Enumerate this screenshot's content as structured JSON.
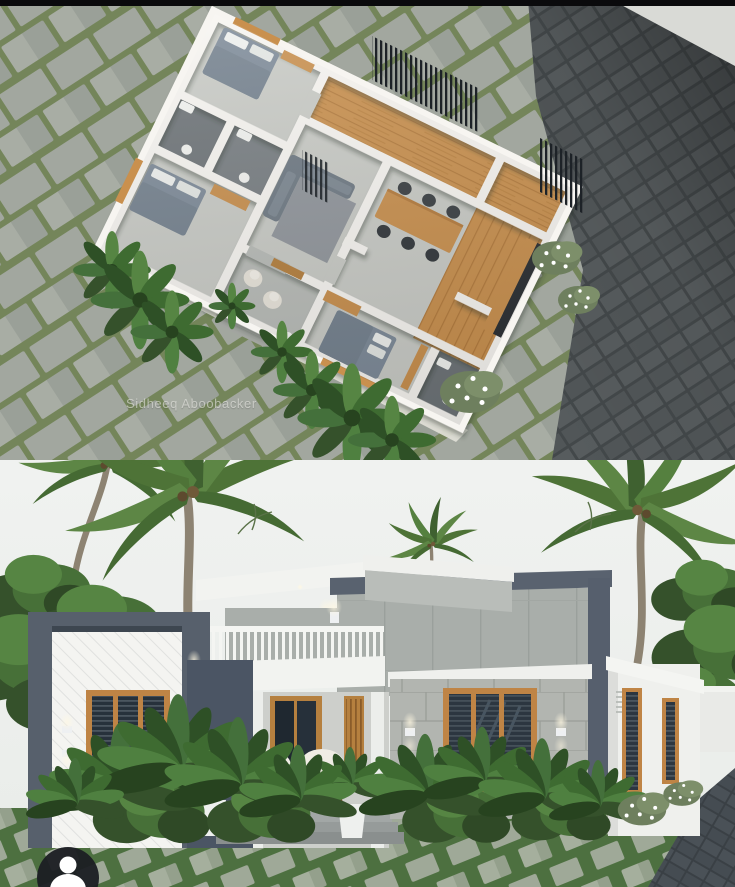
{
  "watermark": {
    "text": "Sidheeq Aboobacker"
  },
  "avatar": {
    "icon": "person-icon"
  },
  "panels": {
    "top": {
      "label": "3D isometric floor plan render"
    },
    "bottom": {
      "label": "House exterior front elevation render"
    }
  },
  "palette": {
    "top_bar": "#0a0a0c",
    "paver_grey": "#a2a79f",
    "grass_joint_green": "#74855a",
    "road_dark": "#45494b",
    "plan_wall_white": "#f7f5f1",
    "wood": "#c9904e",
    "floor_grey": "#c9cbc6",
    "bath_grey": "#6e7478",
    "bed_grey": "#7e8b99",
    "sky": "#eef0ee",
    "house_frame_grey": "#57606c",
    "concrete": "#a9aeaa",
    "stone_wall": "#b2b5b0",
    "window_wood": "#bf8445",
    "glass_dark": "#2c3640",
    "lawn_green": "#4d7040",
    "palm_green": "#4e7337",
    "driveway_dark": "#3a4045",
    "avatar_bg": "#1b1e23"
  }
}
